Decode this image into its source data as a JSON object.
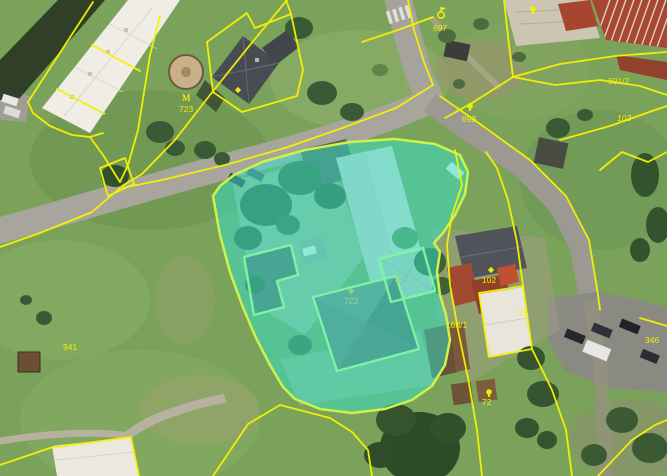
{
  "map": {
    "style": {
      "cadastral_line_color": "#f6f200",
      "selected_parcel_fill": "#2fe3cb",
      "selected_parcel_fill_opacity": 0.5,
      "selected_parcel_border": "#cdf24a",
      "inner_building_outline_color": "#7ef7a2",
      "label_color": "#f0ed08",
      "faint_label_color": "#9fdc72"
    },
    "selected_parcel": {
      "highlighted": true,
      "label": "722"
    },
    "parcel_labels": [
      {
        "text": "723",
        "x": 179,
        "y": 112,
        "variant": ""
      },
      {
        "text": "697",
        "x": 433,
        "y": 31,
        "variant": ""
      },
      {
        "text": "693",
        "x": 462,
        "y": 122,
        "variant": ""
      },
      {
        "text": "691/2",
        "x": 608,
        "y": 84,
        "variant": ""
      },
      {
        "text": "103",
        "x": 617,
        "y": 121,
        "variant": "italic"
      },
      {
        "text": "102",
        "x": 482,
        "y": 283,
        "variant": ""
      },
      {
        "text": "77",
        "x": 518,
        "y": 316,
        "variant": ""
      },
      {
        "text": "108/1",
        "x": 446,
        "y": 328,
        "variant": ""
      },
      {
        "text": "941",
        "x": 63,
        "y": 350,
        "variant": ""
      },
      {
        "text": "72",
        "x": 482,
        "y": 405,
        "variant": ""
      },
      {
        "text": "722",
        "x": 344,
        "y": 304,
        "variant": "faint"
      },
      {
        "text": "346",
        "x": 645,
        "y": 343,
        "variant": ""
      }
    ],
    "point_symbols": [
      {
        "type": "flag",
        "x": 441,
        "y": 15
      },
      {
        "type": "tree-m",
        "x": 187,
        "y": 97
      },
      {
        "type": "pin",
        "x": 470,
        "y": 106
      },
      {
        "type": "pin",
        "x": 489,
        "y": 392
      },
      {
        "type": "pin",
        "x": 533,
        "y": 9
      },
      {
        "type": "diamond",
        "x": 491,
        "y": 270
      },
      {
        "type": "diamond",
        "x": 238,
        "y": 90
      },
      {
        "type": "diamond-faint",
        "x": 351,
        "y": 291
      },
      {
        "type": "diamond-faint",
        "x": 398,
        "y": 281
      }
    ]
  }
}
